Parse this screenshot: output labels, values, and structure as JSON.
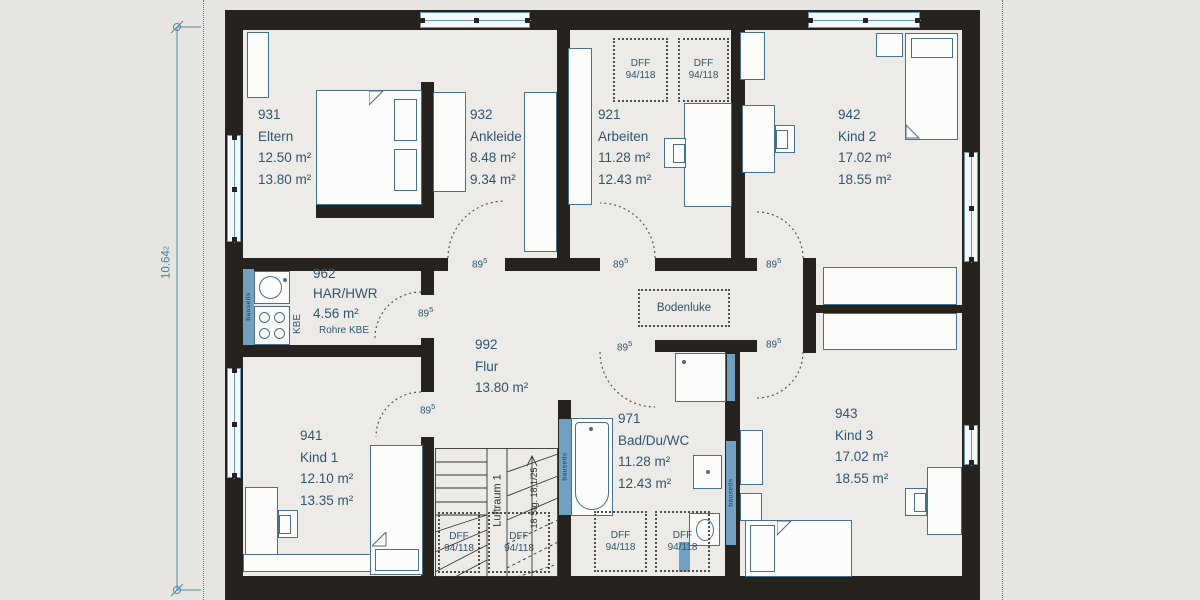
{
  "rooms": [
    {
      "num": "931",
      "name": "Eltern",
      "a1": "12.50 m²",
      "a2": "13.80 m²"
    },
    {
      "num": "932",
      "name": "Ankleide",
      "a1": "8.48 m²",
      "a2": "9.34 m²"
    },
    {
      "num": "921",
      "name": "Arbeiten",
      "a1": "11.28 m²",
      "a2": "12.43 m²"
    },
    {
      "num": "942",
      "name": "Kind 2",
      "a1": "17.02 m²",
      "a2": "18.55 m²"
    },
    {
      "num": "962",
      "name": "HAR/HWR",
      "a1": "4.56 m²",
      "note": "Rohre KBE"
    },
    {
      "num": "992",
      "name": "Flur",
      "a1": "13.80 m²"
    },
    {
      "num": "941",
      "name": "Kind 1",
      "a1": "12.10 m²",
      "a2": "13.35 m²"
    },
    {
      "num": "971",
      "name": "Bad/Du/WC",
      "a1": "11.28 m²",
      "a2": "12.43 m²"
    },
    {
      "num": "943",
      "name": "Kind 3",
      "a1": "17.02 m²",
      "a2": "18.55 m²"
    }
  ],
  "labels": {
    "roof_window": "DFF",
    "roof_window_size": "94/118",
    "door_width": "89",
    "door_width_sup": "5",
    "floor_hatch": "Bodenluke",
    "void": "Luftraum 1",
    "stair_spec": "18 Stg. 18,1/25",
    "kbe": "KBE",
    "onsite": "bauseits",
    "dim_value": "10.64",
    "dim_sup": "2"
  },
  "colors": {
    "wall": "#26221e",
    "floor": "#edebe7",
    "background": "#e7e5e1",
    "ink": "#2e566e",
    "fixture_outline": "#49708a",
    "window_blue": "#6e97b1",
    "onsite_blue": "#72a0c0",
    "dimension": "#4f8aa0"
  }
}
